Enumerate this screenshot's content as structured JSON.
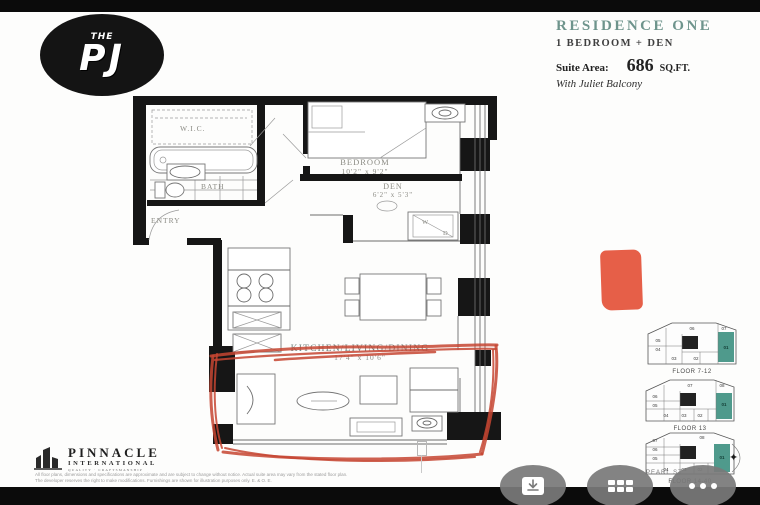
{
  "logo": {
    "the": "THE",
    "pj": "PJ"
  },
  "title_block": {
    "residence": "RESIDENCE ONE",
    "type": "1 BEDROOM + DEN",
    "suite_area_label": "Suite Area:",
    "suite_area_value": "686",
    "suite_area_unit": "SQ.FT.",
    "note": "With Juliet Balcony"
  },
  "floorplan": {
    "wic": "W.I.C.",
    "bath": "BATH",
    "entry": "ENTRY",
    "bedroom": "BEDROOM",
    "bedroom_dims": "10'2\" x 9'2\"",
    "den": "DEN",
    "den_dims": "6'2\" x 5'3\"",
    "washer": "W",
    "dryer": "D",
    "kld": "KITCHEN/LIVING/DINING",
    "kld_dims": "17'4\" x 10'6\"",
    "annotation_color": "#c64531",
    "marker_color": "#e4533a",
    "highlight_color": "#4f9a8c"
  },
  "keyplans": [
    {
      "label": "FLOOR 7-12",
      "units": [
        "06",
        "05",
        "04",
        "03",
        "02",
        "07"
      ],
      "highlighted_unit": "01"
    },
    {
      "label": "FLOOR 13",
      "units": [
        "07",
        "06",
        "05",
        "04",
        "03",
        "02",
        "08"
      ],
      "highlighted_unit": "01"
    },
    {
      "label": "FLOOR 14-40",
      "units": [
        "07",
        "06",
        "05",
        "04",
        "03",
        "02",
        "08"
      ],
      "highlighted_unit": "01"
    }
  ],
  "street_label": "PEARL ST",
  "developer": {
    "line1": "PINNACLE",
    "line2": "INTERNATIONAL",
    "line3": "QUALITY · CRAFTSMANSHIP"
  },
  "disclaimer": {
    "line1": "All floor plans, dimensions and specifications are approximate and are subject to change without notice. Actual suite area may vary from the stated floor plan.",
    "line2": "The developer reserves the right to make modifications. Furnishings are shown for illustration purposes only. E. & O. E."
  },
  "toolbar": {
    "buttons": [
      {
        "icon": "download-icon"
      },
      {
        "icon": "grid-icon"
      },
      {
        "icon": "more-icon"
      }
    ]
  }
}
